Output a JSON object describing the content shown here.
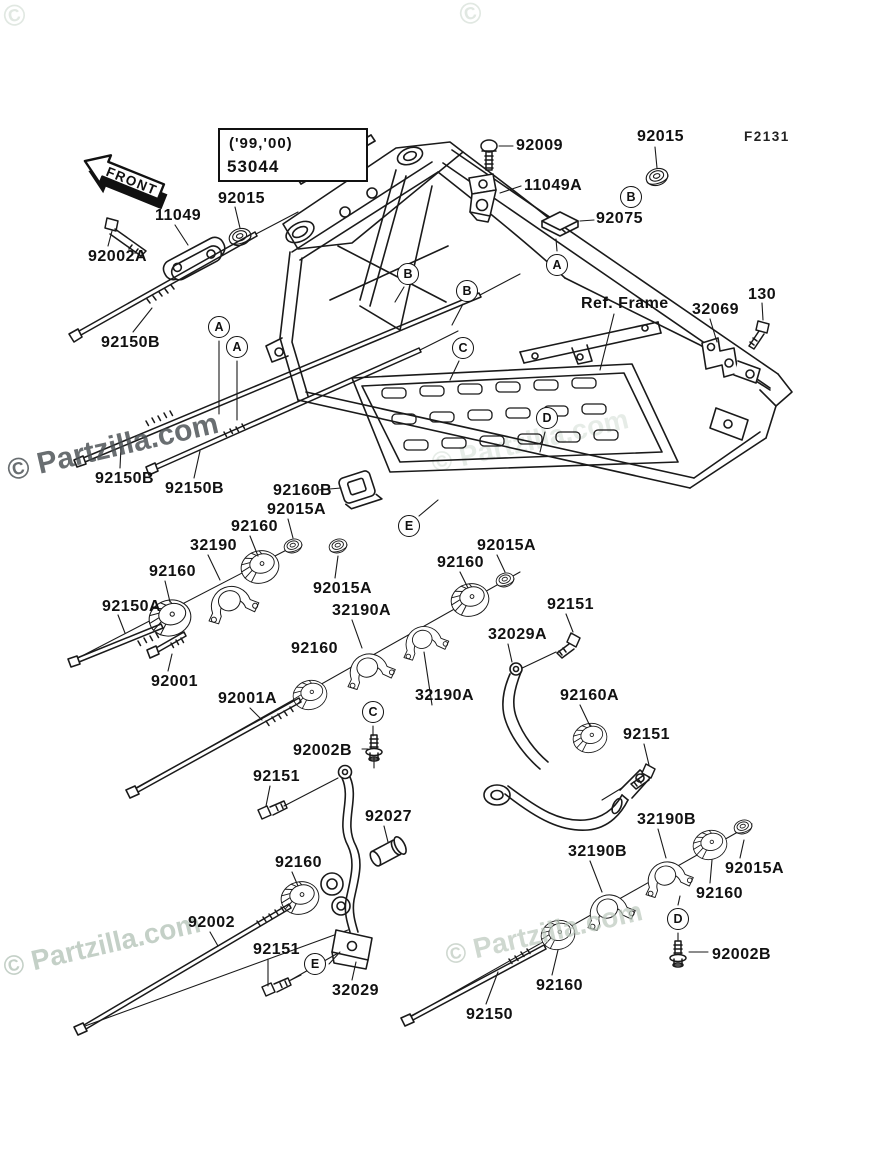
{
  "doc": {
    "figure_code": "F2131",
    "ref_frame_label": "Ref. Frame",
    "front_label": "FRONT",
    "note_box": {
      "line1": "('99,'00)",
      "line2": "53044"
    },
    "watermark": "© Partzilla.com",
    "watermark_fragment": "©",
    "line_color": "#1a1a1a",
    "watermark_dark_color": "rgba(72,78,82,.82)",
    "watermark_light_color": "rgba(186,200,188,.70)"
  },
  "part_labels": [
    {
      "id": "92009",
      "text": "92009",
      "x": 516,
      "y": 137
    },
    {
      "id": "11049A",
      "text": "11049A",
      "x": 524,
      "y": 177
    },
    {
      "id": "92015-tr",
      "text": "92015",
      "x": 637,
      "y": 128
    },
    {
      "id": "92075",
      "text": "92075",
      "x": 596,
      "y": 210
    },
    {
      "id": "92015-tl",
      "text": "92015",
      "x": 218,
      "y": 190
    },
    {
      "id": "11049",
      "text": "11049",
      "x": 155,
      "y": 207
    },
    {
      "id": "92002A",
      "text": "92002A",
      "x": 88,
      "y": 248
    },
    {
      "id": "92150B-1",
      "text": "92150B",
      "x": 101,
      "y": 334
    },
    {
      "id": "32069",
      "text": "32069",
      "x": 692,
      "y": 301
    },
    {
      "id": "130",
      "text": "130",
      "x": 748,
      "y": 286
    },
    {
      "id": "92150B-2",
      "text": "92150B",
      "x": 95,
      "y": 470
    },
    {
      "id": "92150B-3",
      "text": "92150B",
      "x": 165,
      "y": 480
    },
    {
      "id": "92160B",
      "text": "92160B",
      "x": 273,
      "y": 482
    },
    {
      "id": "92015A-1",
      "text": "92015A",
      "x": 267,
      "y": 501
    },
    {
      "id": "92160-1",
      "text": "92160",
      "x": 231,
      "y": 518
    },
    {
      "id": "32190",
      "text": "32190",
      "x": 190,
      "y": 537
    },
    {
      "id": "92160-2",
      "text": "92160",
      "x": 149,
      "y": 563
    },
    {
      "id": "92150A",
      "text": "92150A",
      "x": 102,
      "y": 598
    },
    {
      "id": "92015A-2",
      "text": "92015A",
      "x": 313,
      "y": 580
    },
    {
      "id": "32190A-1",
      "text": "32190A",
      "x": 332,
      "y": 602
    },
    {
      "id": "92015A-3",
      "text": "92015A",
      "x": 477,
      "y": 537
    },
    {
      "id": "92160-3",
      "text": "92160",
      "x": 437,
      "y": 554
    },
    {
      "id": "92151-1",
      "text": "92151",
      "x": 547,
      "y": 596
    },
    {
      "id": "32029A",
      "text": "32029A",
      "x": 488,
      "y": 626
    },
    {
      "id": "92160-4",
      "text": "92160",
      "x": 291,
      "y": 640
    },
    {
      "id": "92001",
      "text": "92001",
      "x": 151,
      "y": 673
    },
    {
      "id": "92001A",
      "text": "92001A",
      "x": 218,
      "y": 690
    },
    {
      "id": "32190A-2",
      "text": "32190A",
      "x": 415,
      "y": 687
    },
    {
      "id": "92160A",
      "text": "92160A",
      "x": 560,
      "y": 687
    },
    {
      "id": "92151-2",
      "text": "92151",
      "x": 623,
      "y": 726
    },
    {
      "id": "92002B-1",
      "text": "92002B",
      "x": 293,
      "y": 742
    },
    {
      "id": "92151-3",
      "text": "92151",
      "x": 253,
      "y": 768
    },
    {
      "id": "92027",
      "text": "92027",
      "x": 365,
      "y": 808
    },
    {
      "id": "32190B-1",
      "text": "32190B",
      "x": 637,
      "y": 811
    },
    {
      "id": "92160-5",
      "text": "92160",
      "x": 275,
      "y": 854
    },
    {
      "id": "32190B-2",
      "text": "32190B",
      "x": 568,
      "y": 843
    },
    {
      "id": "92015A-4",
      "text": "92015A",
      "x": 725,
      "y": 860
    },
    {
      "id": "92160-6",
      "text": "92160",
      "x": 696,
      "y": 885
    },
    {
      "id": "92002",
      "text": "92002",
      "x": 188,
      "y": 914
    },
    {
      "id": "92151-4",
      "text": "92151",
      "x": 253,
      "y": 941
    },
    {
      "id": "92002B-2",
      "text": "92002B",
      "x": 712,
      "y": 946
    },
    {
      "id": "32029",
      "text": "32029",
      "x": 332,
      "y": 982
    },
    {
      "id": "92160-7",
      "text": "92160",
      "x": 536,
      "y": 977
    },
    {
      "id": "92150",
      "text": "92150",
      "x": 466,
      "y": 1006
    }
  ],
  "callouts": [
    {
      "id": "A-1",
      "letter": "A",
      "x": 557,
      "y": 265
    },
    {
      "id": "A-2",
      "letter": "A",
      "x": 219,
      "y": 327
    },
    {
      "id": "A-3",
      "letter": "A",
      "x": 237,
      "y": 347
    },
    {
      "id": "B-1",
      "letter": "B",
      "x": 631,
      "y": 197
    },
    {
      "id": "B-2",
      "letter": "B",
      "x": 408,
      "y": 274
    },
    {
      "id": "B-3",
      "letter": "B",
      "x": 467,
      "y": 291
    },
    {
      "id": "C-1",
      "letter": "C",
      "x": 463,
      "y": 348
    },
    {
      "id": "C-2",
      "letter": "C",
      "x": 373,
      "y": 712
    },
    {
      "id": "D-1",
      "letter": "D",
      "x": 547,
      "y": 418
    },
    {
      "id": "D-2",
      "letter": "D",
      "x": 678,
      "y": 919
    },
    {
      "id": "E-1",
      "letter": "E",
      "x": 409,
      "y": 526
    },
    {
      "id": "E-2",
      "letter": "E",
      "x": 315,
      "y": 964
    }
  ]
}
